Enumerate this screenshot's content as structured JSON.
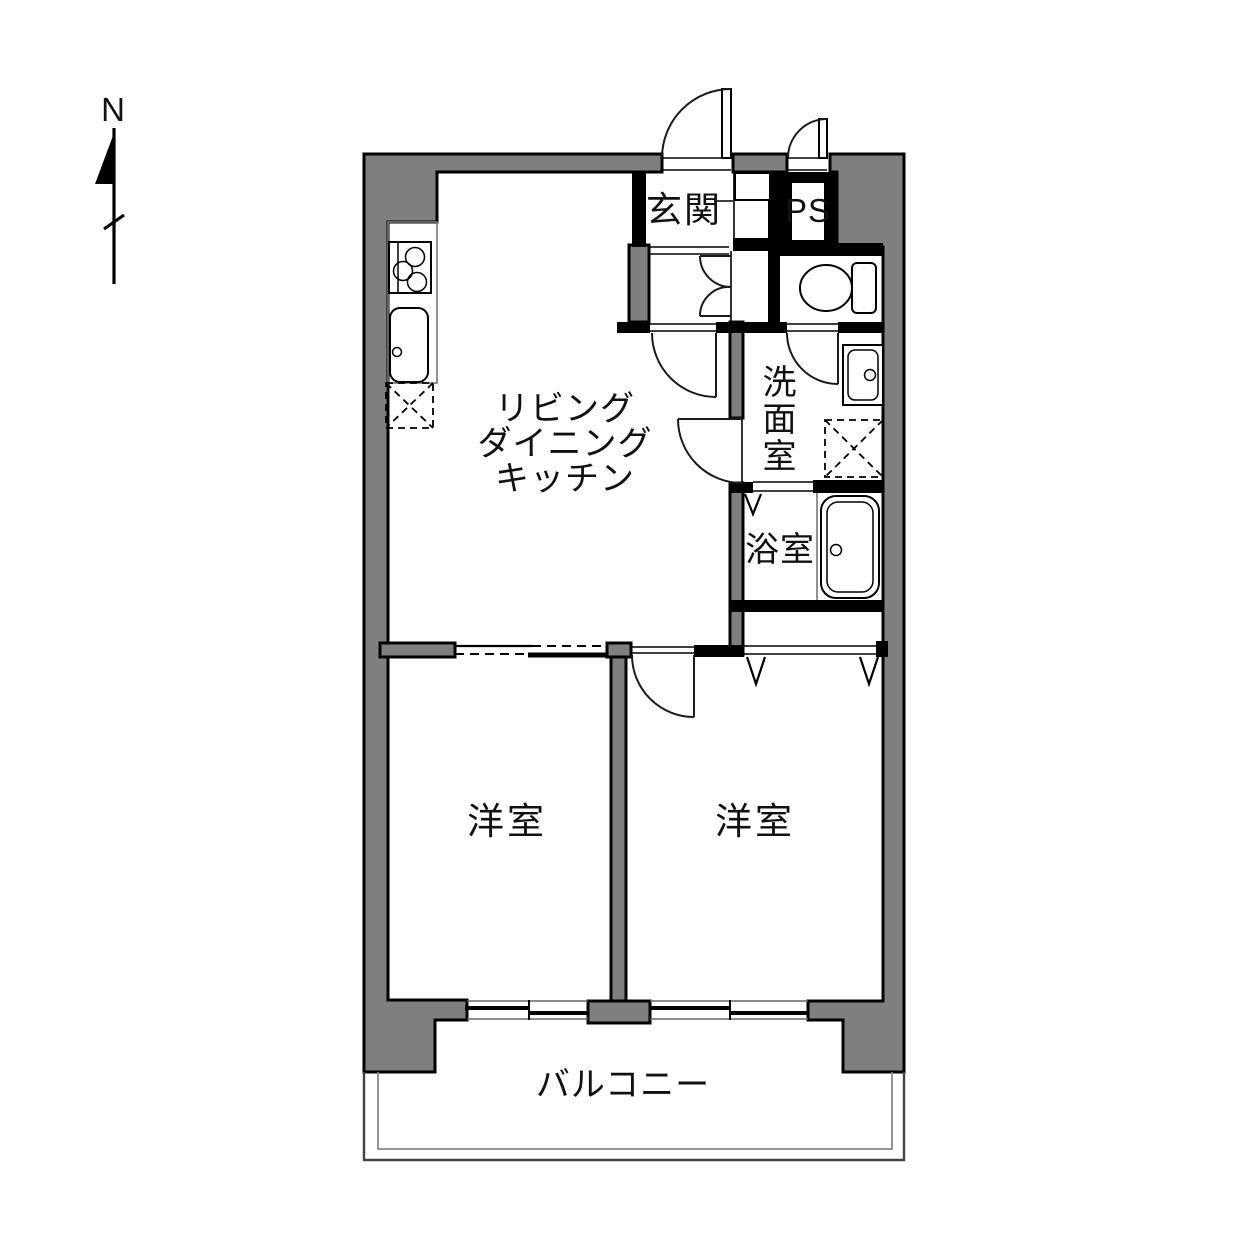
{
  "compass": {
    "north_label": "N"
  },
  "rooms": {
    "ldk": {
      "line1": "リビング",
      "line2": "ダイニング",
      "line3": "キッチン"
    },
    "genkan": {
      "label": "玄関"
    },
    "pipe_space": {
      "label": "PS"
    },
    "washroom": {
      "char1": "洗",
      "char2": "面",
      "char3": "室"
    },
    "bathroom": {
      "label": "浴室"
    },
    "bedroom_left": {
      "label": "洋室"
    },
    "bedroom_right": {
      "label": "洋室"
    },
    "balcony": {
      "label": "バルコニー"
    }
  },
  "colors": {
    "wall_fill": "#7f7f7f",
    "wall_outline": "#000000",
    "background": "#ffffff",
    "line": "#1a1a1a"
  }
}
